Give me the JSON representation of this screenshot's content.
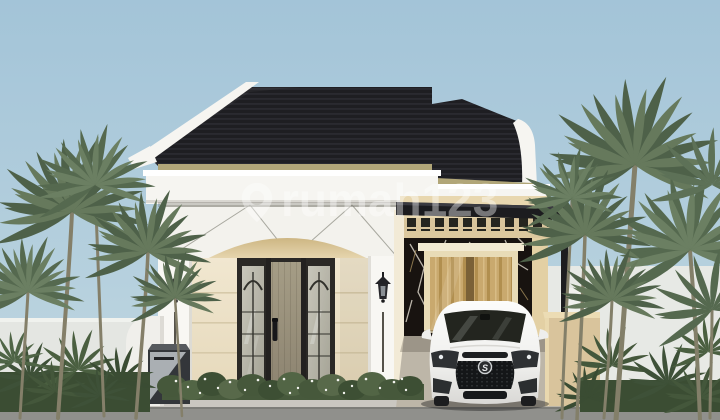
{
  "watermark": {
    "icon": "location-pin-icon",
    "text": "rumah123"
  },
  "car_emblem": "S",
  "theme": {
    "sky-top": "#a3c4d8",
    "sky-bottom": "#c3d9e2",
    "roof": "#1d1d21",
    "roof-band": "#b1a678",
    "trim": "#f6f5f1",
    "pediment": "#f3f2ed",
    "wall": "#efe5cd",
    "arch": "#dbc597",
    "pillar": "#f8f7f3",
    "door-frame": "#2b2926",
    "door-panel": "#9a9180",
    "glass": "#c7c4b8",
    "marble": "#181310",
    "vein": "#d8d2c6",
    "carport-cream": "#e8d7af",
    "curtain": "#c79f63",
    "beam": "#1c1c1f",
    "boundary-wall": "#d9c49c",
    "gate-wall": "#f0efeb",
    "mailbox": "#33363a",
    "hedge": "#47593c",
    "palm-dark": "#4e6149",
    "palm-light": "#66795c",
    "trunk": "#847f69",
    "sidewalk": "#cac7c1",
    "road": "#90908c",
    "driveway": "#bdb6a8",
    "car-body": "#f5f5f3",
    "car-glass": "#23251f",
    "watermark": "rgba(255,255,255,0.40)"
  }
}
